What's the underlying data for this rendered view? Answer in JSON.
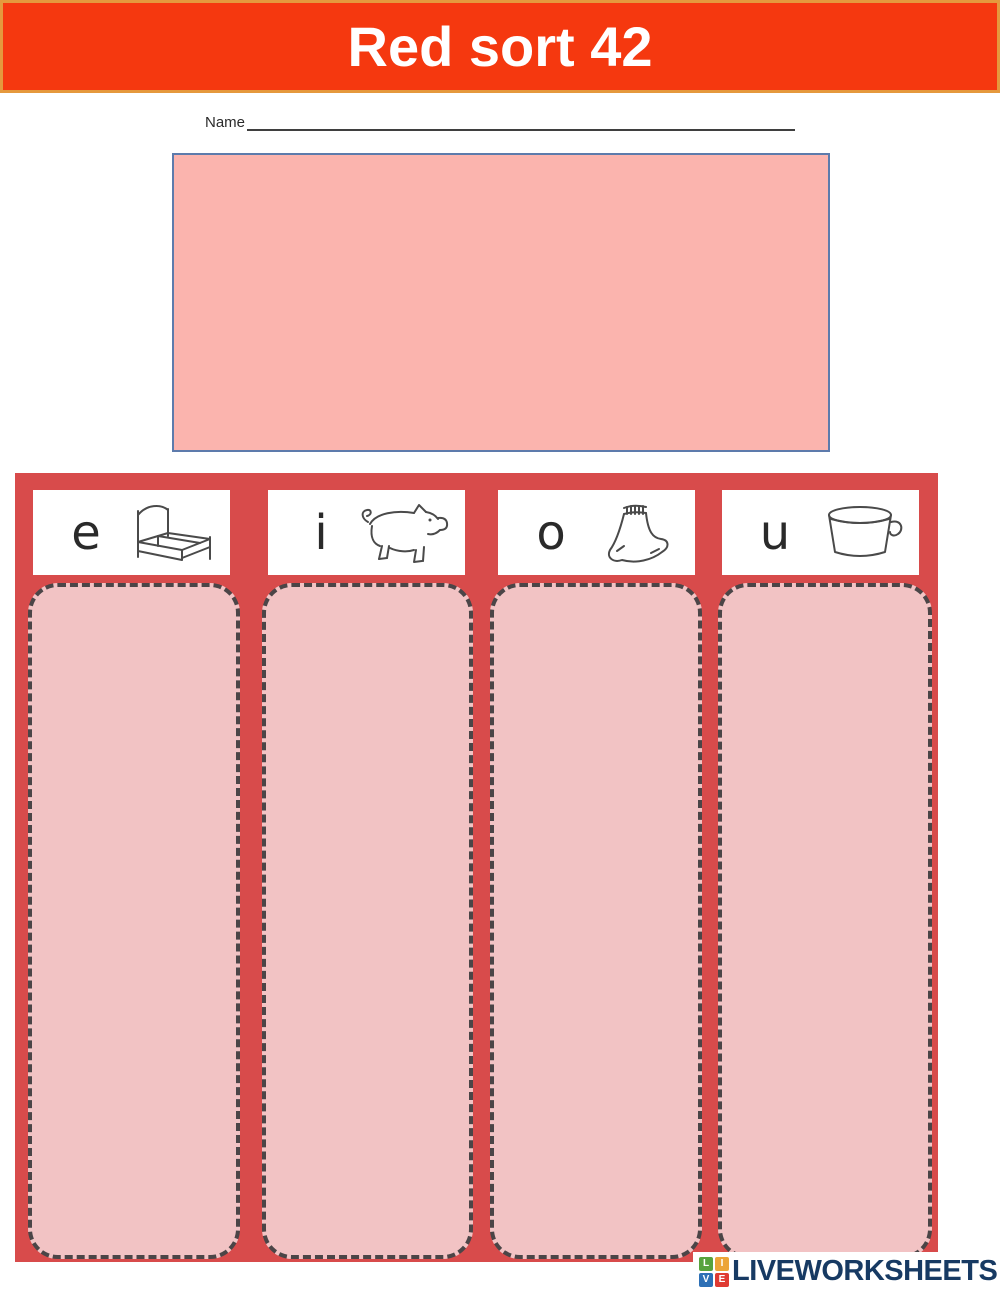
{
  "banner": {
    "title": "Red sort 42",
    "bg_color": "#f5380f",
    "border_color": "#e5993d",
    "text_color": "#ffffff"
  },
  "name_field": {
    "label": "Name"
  },
  "word_bank_box": {
    "fill_color": "#fbb4ae",
    "border_color": "#5d7bac"
  },
  "board": {
    "bg_color": "#d84b4b",
    "column_fill": "#f2c3c4",
    "column_dash_color": "#4b4547",
    "headers": [
      {
        "letter": "e",
        "icon": "bed-icon"
      },
      {
        "letter": "i",
        "icon": "pig-icon"
      },
      {
        "letter": "o",
        "icon": "sock-icon"
      },
      {
        "letter": "u",
        "icon": "cup-icon"
      }
    ]
  },
  "footer_logo": {
    "squares": [
      "L",
      "I",
      "V",
      "E"
    ],
    "square_colors": [
      "#57a33e",
      "#eca438",
      "#2d70b6",
      "#df3b33"
    ],
    "text": "LIVEWORKSHEETS",
    "text_color": "#173a63"
  }
}
